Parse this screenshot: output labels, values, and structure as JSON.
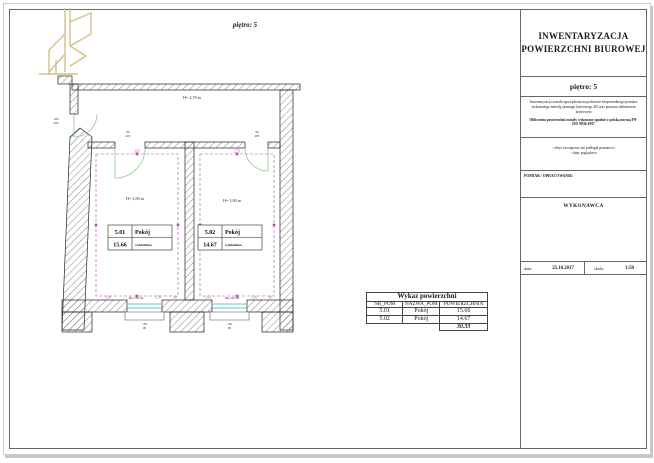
{
  "colors": {
    "logo_gold": "#d4bf8b",
    "dimension_magenta": "#b44fb4",
    "door_green": "#8fca8f",
    "window_cyan": "#63c8c8",
    "frame_grey": "#666666"
  },
  "plan": {
    "floor_label": "piętro:  5",
    "corridor_height_label": "H= 2,70 m",
    "corridor_door_label": {
      "top": "100",
      "bottom": "205"
    },
    "rooms": [
      {
        "number": "5.01",
        "name": "Pokój",
        "area": "15.66",
        "flooring": "wykładzina",
        "height_label": "H= 2,80 m",
        "top_dim": "3,05",
        "bottom_dims": {
          "left": "1,08",
          "mid": "1,50",
          "right": "40"
        },
        "parapet_label": "Hp= 90 cm",
        "door_label": {
          "top": "90",
          "bottom": "205"
        },
        "window_label": {
          "top": "150",
          "bottom": "90"
        }
      },
      {
        "number": "5.02",
        "name": "Pokój",
        "area": "14.67",
        "flooring": "wykładzina",
        "height_label": "H= 2,80 m",
        "top_dim": "2,75",
        "bottom_dims": {
          "left": "1,03",
          "mid": "1,50",
          "right": "40"
        },
        "parapet_label": "Hp= 90 cm",
        "door_label": {
          "top": "90",
          "bottom": "205"
        },
        "window_label": {
          "top": "150",
          "bottom": "90"
        }
      }
    ]
  },
  "table": {
    "title": "Wykaz powierzchni",
    "columns": [
      "NR_POM",
      "NAZWA_POM",
      "POWIERZCHNIA"
    ],
    "rows": [
      {
        "nr": "5.01",
        "nazwa": "Pokój",
        "pow": "15.66"
      },
      {
        "nr": "5.02",
        "nazwa": "Pokój",
        "pow": "14.67"
      }
    ],
    "total": "30.33"
  },
  "titleblock": {
    "title_line1": "INWENTARYZACJA",
    "title_line2": "POWIERZCHNI BIUROWEJ",
    "floor_label": "piętro:  5",
    "note1": "Inwentaryzacja została sporządzona na podstawie bezpośredniego pomiaru wykonanego metodą skaningu laserowego 3D oraz pomiaru dalmierzem laserowym",
    "note2": "Obliczenia powierzchni zostały wykonane zgodnie z polską normą PN-ISO 9836:1997",
    "note3_line1": "- obrys zewnętrzny nie podlegał pomiarowi",
    "note3_line2": "- służy poglądowo",
    "pomiar_label": "POMIAR / OPRACOWANIE:",
    "wykonawca_label": "WYKONAWCA",
    "footer": {
      "date_label": "data:",
      "date": "25.10.2017",
      "scale_label": "skala:",
      "scale": "1:50"
    }
  }
}
